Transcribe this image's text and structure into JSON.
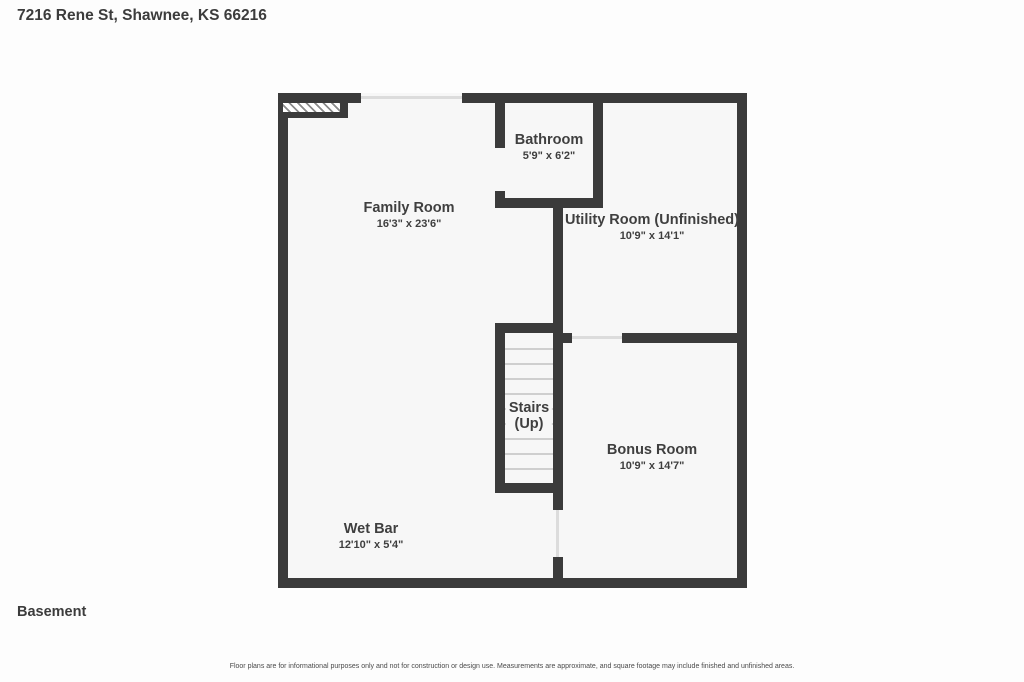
{
  "page": {
    "title": "7216 Rene St, Shawnee, KS 66216",
    "floor_label": "Basement",
    "disclaimer": "Floor plans are for informational purposes only and not for construction or design use. Measurements are approximate, and square footage may include finished and unfinished areas."
  },
  "floorplan": {
    "rooms": {
      "family_room": {
        "name": "Family Room",
        "dims": "16'3\" x 23'6\""
      },
      "bathroom": {
        "name": "Bathroom",
        "dims": "5'9\" x 6'2\""
      },
      "utility_room": {
        "name": "Utility Room (Unfinished)",
        "dims": "10'9\" x 14'1\""
      },
      "stairs": {
        "name": "Stairs",
        "sub": "(Up)"
      },
      "bonus_room": {
        "name": "Bonus Room",
        "dims": "10'9\" x 14'7\""
      },
      "wet_bar": {
        "name": "Wet Bar",
        "dims": "12'10\" x 5'4\""
      }
    },
    "colors": {
      "wall": "#3b3b3b",
      "floor": "#f7f7f7",
      "text": "#3f3f3f"
    }
  }
}
